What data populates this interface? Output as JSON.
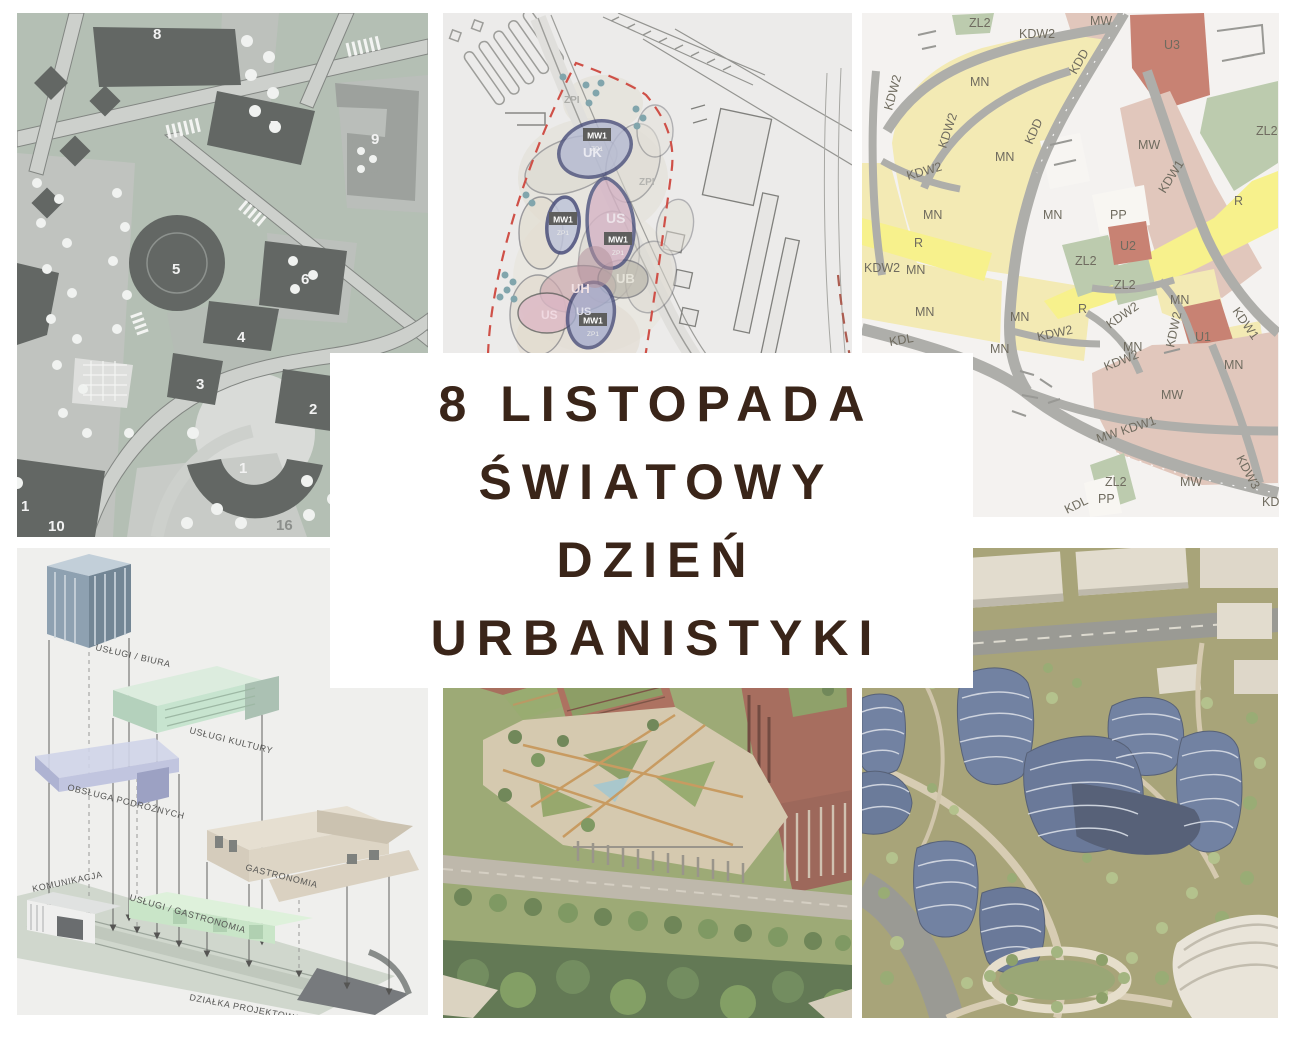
{
  "title": {
    "lines": [
      "8 LISTOPADA",
      "ŚWIATOWY",
      "DZIEŃ",
      "URBANISTYKI"
    ],
    "text_color": "#3a2519",
    "box_color": "#ffffff"
  },
  "panels": {
    "masterplan": {
      "numbers": [
        {
          "t": "8",
          "x": 136,
          "y": 26
        },
        {
          "t": "7",
          "x": 253,
          "y": 118
        },
        {
          "t": "9",
          "x": 354,
          "y": 131
        },
        {
          "t": "5",
          "x": 155,
          "y": 261
        },
        {
          "t": "6",
          "x": 284,
          "y": 271
        },
        {
          "t": "4",
          "x": 220,
          "y": 329
        },
        {
          "t": "3",
          "x": 179,
          "y": 376
        },
        {
          "t": "2",
          "x": 292,
          "y": 401
        },
        {
          "t": "1",
          "x": 222,
          "y": 460
        },
        {
          "t": "1",
          "x": 4,
          "y": 498
        },
        {
          "t": "10",
          "x": 31,
          "y": 518
        },
        {
          "t": "16",
          "x": 259,
          "y": 517,
          "c": "#7b7f7b"
        }
      ]
    },
    "siteplan": {
      "labels": [
        {
          "t": "ZPI",
          "x": 121,
          "y": 90,
          "s": 10,
          "c": "#a0a09c"
        },
        {
          "t": "ZPI",
          "x": 196,
          "y": 172,
          "s": 10,
          "c": "#a8a8a4"
        },
        {
          "t": "UK",
          "x": 140,
          "y": 144,
          "s": 13,
          "c": "#e8e8f0"
        },
        {
          "t": "US",
          "x": 163,
          "y": 210,
          "s": 14,
          "c": "#eadfe6"
        },
        {
          "t": "UH",
          "x": 128,
          "y": 280,
          "s": 13,
          "c": "#f0dee1"
        },
        {
          "t": "UB",
          "x": 173,
          "y": 270,
          "s": 13,
          "c": "#e2dfd4"
        },
        {
          "t": "US",
          "x": 133,
          "y": 302,
          "s": 11,
          "c": "#dcdcea"
        },
        {
          "t": "US",
          "x": 98,
          "y": 306,
          "s": 12,
          "c": "#eed4dd"
        }
      ],
      "badges": [
        {
          "t": "MW1",
          "sub": "ZP1",
          "x": 154,
          "y": 124
        },
        {
          "t": "MW1",
          "sub": "ZP1",
          "x": 120,
          "y": 208
        },
        {
          "t": "MW1",
          "sub": "ZP1",
          "x": 175,
          "y": 228
        },
        {
          "t": "MW1",
          "sub": "ZP1",
          "x": 150,
          "y": 309
        }
      ]
    },
    "zoning": {
      "labels": [
        {
          "t": "ZL2",
          "x": 107,
          "y": 14
        },
        {
          "t": "KDW2",
          "x": 157,
          "y": 25
        },
        {
          "t": "MW",
          "x": 228,
          "y": 12
        },
        {
          "t": "U3",
          "x": 302,
          "y": 36
        },
        {
          "t": "MN",
          "x": 108,
          "y": 73
        },
        {
          "t": "KDW2",
          "x": 30,
          "y": 98,
          "r": -75
        },
        {
          "t": "KDD",
          "x": 214,
          "y": 62,
          "r": -60
        },
        {
          "t": "ZL2",
          "x": 394,
          "y": 122
        },
        {
          "t": "KDW2",
          "x": 84,
          "y": 136,
          "r": -72
        },
        {
          "t": "MN",
          "x": 133,
          "y": 148
        },
        {
          "t": "KDD",
          "x": 170,
          "y": 132,
          "r": -66
        },
        {
          "t": "MW",
          "x": 276,
          "y": 136
        },
        {
          "t": "KDW2",
          "x": 46,
          "y": 167,
          "r": -16
        },
        {
          "t": "MN",
          "x": 61,
          "y": 206
        },
        {
          "t": "MN",
          "x": 181,
          "y": 206
        },
        {
          "t": "PP",
          "x": 248,
          "y": 206
        },
        {
          "t": "KDW1",
          "x": 303,
          "y": 181,
          "r": -58
        },
        {
          "t": "R",
          "x": 372,
          "y": 192
        },
        {
          "t": "R",
          "x": 52,
          "y": 234
        },
        {
          "t": "U2",
          "x": 258,
          "y": 237
        },
        {
          "t": "ZL2",
          "x": 213,
          "y": 252
        },
        {
          "t": "KDW2",
          "x": 2,
          "y": 259
        },
        {
          "t": "MN",
          "x": 44,
          "y": 261
        },
        {
          "t": "MN",
          "x": 53,
          "y": 303
        },
        {
          "t": "KDL",
          "x": 28,
          "y": 333,
          "r": -10
        },
        {
          "t": "ZL2",
          "x": 252,
          "y": 276
        },
        {
          "t": "R",
          "x": 216,
          "y": 300
        },
        {
          "t": "MN",
          "x": 308,
          "y": 291
        },
        {
          "t": "KDW1",
          "x": 370,
          "y": 298,
          "r": 55
        },
        {
          "t": "MN",
          "x": 148,
          "y": 308
        },
        {
          "t": "KDW2",
          "x": 176,
          "y": 328,
          "r": -12
        },
        {
          "t": "KDW2",
          "x": 248,
          "y": 316,
          "r": -35
        },
        {
          "t": "MN",
          "x": 128,
          "y": 340
        },
        {
          "t": "MN",
          "x": 261,
          "y": 338
        },
        {
          "t": "KDW2",
          "x": 312,
          "y": 335,
          "r": -78
        },
        {
          "t": "U1",
          "x": 333,
          "y": 328
        },
        {
          "t": "KDW2",
          "x": 244,
          "y": 358,
          "r": -22
        },
        {
          "t": "MN",
          "x": 362,
          "y": 356
        },
        {
          "t": "MW",
          "x": 299,
          "y": 386
        },
        {
          "t": "MW KDW1",
          "x": 236,
          "y": 430,
          "r": -18
        },
        {
          "t": "KDW3",
          "x": 374,
          "y": 445,
          "r": 62
        },
        {
          "t": "ZL2",
          "x": 243,
          "y": 473
        },
        {
          "t": "PP",
          "x": 236,
          "y": 490
        },
        {
          "t": "MW",
          "x": 318,
          "y": 473
        },
        {
          "t": "KD",
          "x": 400,
          "y": 493
        },
        {
          "t": "KDL",
          "x": 205,
          "y": 501,
          "r": -26
        }
      ]
    },
    "axonometric": {
      "labels": [
        {
          "t": "USŁUGI / BIURA",
          "x": 78,
          "y": 102,
          "r": 13
        },
        {
          "t": "USŁUGI KULTURY",
          "x": 172,
          "y": 185,
          "r": 14
        },
        {
          "t": "OBSŁUGA PODRÓŻNYCH",
          "x": 50,
          "y": 242,
          "r": 14
        },
        {
          "t": "KOMUNIKACJA",
          "x": 16,
          "y": 344,
          "r": -12
        },
        {
          "t": "GASTRONOMIA",
          "x": 228,
          "y": 322,
          "r": 14
        },
        {
          "t": "USŁUGI / GASTRONOMIA",
          "x": 112,
          "y": 352,
          "r": 16
        },
        {
          "t": "DZIAŁKA PROJEKTOWA",
          "x": 172,
          "y": 452,
          "r": 11
        }
      ]
    }
  },
  "colors": {
    "masterplan_green": "#a9b6a9",
    "masterplan_building": "#4c514e",
    "road_gray": "#c6c9c5",
    "siteplan_bg": "#eae9e7",
    "boundary_red": "#c8372d",
    "navy_outline": "#2f3569",
    "zone_mn_yellow": "#f2e7a9",
    "zone_r_yellow": "#f6ef7b",
    "zone_mw_rose": "#ddbfb2",
    "zone_u_terracotta": "#c0705f",
    "zone_zl_green": "#b2c4a3",
    "zoning_road": "#a3a29e",
    "axo_bg": "#ededeb",
    "campus_brick": "#9c5a47",
    "campus_grass": "#8f9e62",
    "render_olive": "#9b9766",
    "render_blue": "#5d7095"
  }
}
